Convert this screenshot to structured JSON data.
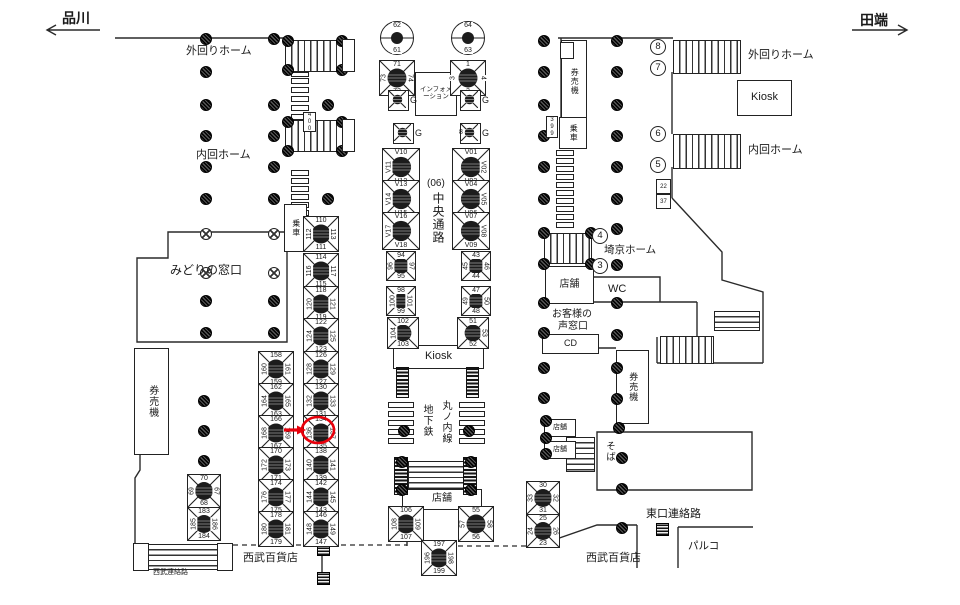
{
  "direction_labels": {
    "left": "品川",
    "right": "田端"
  },
  "labels": [
    {
      "name": "label-shinagawa",
      "t": "品川",
      "x": 62,
      "y": 8,
      "fs": 14,
      "v": false,
      "bold": true
    },
    {
      "name": "label-tabata",
      "t": "田端",
      "x": 860,
      "y": 10,
      "fs": 14,
      "v": false,
      "bold": true
    },
    {
      "name": "label-sotomawari-left",
      "t": "外回りホーム",
      "x": 186,
      "y": 42,
      "fs": 11,
      "v": false
    },
    {
      "name": "label-uchimawari-left",
      "t": "内回ホーム",
      "x": 196,
      "y": 146,
      "fs": 11,
      "v": false
    },
    {
      "name": "label-sotomawari-right",
      "t": "外回りホーム",
      "x": 748,
      "y": 46,
      "fs": 11,
      "v": false
    },
    {
      "name": "label-uchimawari-right",
      "t": "内回ホーム",
      "x": 748,
      "y": 141,
      "fs": 11,
      "v": false
    },
    {
      "name": "label-saikyo-home",
      "t": "埼京ホーム",
      "x": 604,
      "y": 242,
      "fs": 10.5,
      "v": false
    },
    {
      "name": "label-midori-no-madoguchi",
      "t": "みどりの窓口",
      "x": 170,
      "y": 261,
      "fs": 12,
      "v": false
    },
    {
      "name": "label-wc",
      "t": "WC",
      "x": 608,
      "y": 283,
      "fs": 11,
      "v": false
    },
    {
      "name": "label-okyakusama-1",
      "t": "お客様の",
      "x": 552,
      "y": 305,
      "fs": 10,
      "v": false
    },
    {
      "name": "label-okyakusama-2",
      "t": "声窓口",
      "x": 558,
      "y": 317,
      "fs": 10,
      "v": false
    },
    {
      "name": "label-higashiguchi",
      "t": "東口連絡路",
      "x": 646,
      "y": 505,
      "fs": 11,
      "v": false
    },
    {
      "name": "label-parco",
      "t": "パルコ",
      "x": 688,
      "y": 538,
      "fs": 10.5,
      "v": false
    },
    {
      "name": "label-seibu-left",
      "t": "西武百貨店",
      "x": 243,
      "y": 549,
      "fs": 11,
      "v": false
    },
    {
      "name": "label-seibu-right",
      "t": "西武百貨店",
      "x": 586,
      "y": 549,
      "fs": 11,
      "v": false
    },
    {
      "name": "label-seibu-renraku",
      "t": "西武連絡路",
      "x": 153,
      "y": 567,
      "fs": 7,
      "v": false
    },
    {
      "name": "label-chuo-06",
      "t": "(06)",
      "x": 427,
      "y": 178,
      "fs": 10,
      "v": false
    },
    {
      "name": "label-chuo-tsuro",
      "t": "中央通路",
      "x": 430,
      "y": 192,
      "fs": 12,
      "v": true
    },
    {
      "name": "label-marunouchi-sen",
      "t": "丸ノ内線",
      "x": 438,
      "y": 400,
      "fs": 10,
      "v": true
    },
    {
      "name": "label-chikatetsu",
      "t": "地下鉄",
      "x": 419,
      "y": 404,
      "fs": 10,
      "v": true
    },
    {
      "name": "label-soba",
      "t": "そば",
      "x": 602,
      "y": 441,
      "fs": 9.5,
      "v": true
    },
    {
      "name": "label-g-extra-8",
      "t": "8",
      "x": 459,
      "y": 129,
      "fs": 7,
      "v": false
    }
  ],
  "circled_numbers": [
    {
      "t": "8",
      "x": 650,
      "y": 39
    },
    {
      "t": "7",
      "x": 650,
      "y": 60
    },
    {
      "t": "6",
      "x": 650,
      "y": 126
    },
    {
      "t": "5",
      "x": 650,
      "y": 157
    },
    {
      "t": "4",
      "x": 592,
      "y": 228
    },
    {
      "t": "3",
      "x": 592,
      "y": 258
    }
  ],
  "boxed_labels": [
    {
      "name": "kiosk-right",
      "t": "Kiosk",
      "x": 737,
      "y": 80,
      "w": 53,
      "h": 34,
      "fs": 11,
      "v": false
    },
    {
      "name": "information-booth",
      "t": "インフォメーション",
      "x": 415,
      "y": 72,
      "w": 38,
      "h": 40,
      "fs": 6.5,
      "v": false,
      "wrap": true
    },
    {
      "name": "kiosk-center",
      "t": "Kiosk",
      "x": 393,
      "y": 345,
      "w": 89,
      "h": 22,
      "fs": 11,
      "v": false
    },
    {
      "name": "tenpo-saikyo",
      "t": "店舗",
      "x": 545,
      "y": 266,
      "w": 47,
      "h": 36,
      "fs": 10,
      "v": false
    },
    {
      "name": "cd-machine",
      "t": "CD",
      "x": 542,
      "y": 334,
      "w": 55,
      "h": 18,
      "fs": 9,
      "v": false
    },
    {
      "name": "kenbaiki-left",
      "t": "券売機",
      "x": 134,
      "y": 348,
      "w": 33,
      "h": 105,
      "fs": 10,
      "v": true
    },
    {
      "name": "kenbaiki-right-top",
      "t": "券売機",
      "x": 561,
      "y": 40,
      "w": 24,
      "h": 80,
      "fs": 8,
      "v": true
    },
    {
      "name": "josha-right",
      "t": "乗車",
      "x": 559,
      "y": 117,
      "w": 26,
      "h": 30,
      "fs": 8,
      "v": true
    },
    {
      "name": "josha-left",
      "t": "乗車",
      "x": 284,
      "y": 204,
      "w": 21,
      "h": 46,
      "fs": 8,
      "v": true
    },
    {
      "name": "kenbaiki-right-bottom",
      "t": "券売機",
      "x": 616,
      "y": 350,
      "w": 31,
      "h": 72,
      "fs": 9,
      "v": true
    },
    {
      "name": "tenpo-small-1",
      "t": "店舗",
      "x": 544,
      "y": 419,
      "w": 30,
      "h": 16,
      "fs": 7,
      "v": false
    },
    {
      "name": "tenpo-small-2",
      "t": "店舗",
      "x": 544,
      "y": 441,
      "w": 30,
      "h": 16,
      "fs": 7,
      "v": false
    },
    {
      "name": "tenpo-center",
      "t": "店舗",
      "x": 402,
      "y": 489,
      "w": 78,
      "h": 19,
      "fs": 10,
      "v": false
    }
  ],
  "circle_signs": [
    {
      "x": 396,
      "y": 37,
      "top": "62",
      "bottom": "61"
    },
    {
      "x": 467,
      "y": 37,
      "top": "64",
      "bottom": "63"
    }
  ],
  "g_signs": [
    {
      "x": 398,
      "y": 100,
      "label": "G"
    },
    {
      "x": 470,
      "y": 100,
      "label": "G"
    },
    {
      "x": 403,
      "y": 133,
      "label": "G"
    },
    {
      "x": 470,
      "y": 133,
      "label": "G"
    }
  ],
  "ad_boxes": [
    {
      "x": 396,
      "y": 77,
      "s": 34,
      "n": [
        "71",
        "72",
        "73",
        "74"
      ]
    },
    {
      "x": 467,
      "y": 77,
      "s": 34,
      "n": [
        "1",
        "2",
        "3",
        "4"
      ]
    },
    {
      "x": 400,
      "y": 166,
      "s": 36,
      "n": [
        "V10",
        "V12",
        "V11",
        ""
      ]
    },
    {
      "x": 400,
      "y": 198,
      "s": 36,
      "n": [
        "V13",
        "V15",
        "V14",
        ""
      ]
    },
    {
      "x": 400,
      "y": 230,
      "s": 36,
      "n": [
        "V16",
        "V18",
        "V17",
        ""
      ]
    },
    {
      "x": 470,
      "y": 166,
      "s": 36,
      "n": [
        "V01",
        "V03",
        "",
        "V02"
      ]
    },
    {
      "x": 470,
      "y": 198,
      "s": 36,
      "n": [
        "V04",
        "V06",
        "",
        "V05"
      ]
    },
    {
      "x": 470,
      "y": 230,
      "s": 36,
      "n": [
        "V07",
        "V09",
        "",
        "V08"
      ]
    },
    {
      "x": 400,
      "y": 265,
      "s": 28,
      "n": [
        "94",
        "95",
        "96",
        "97"
      ]
    },
    {
      "x": 400,
      "y": 300,
      "s": 28,
      "n": [
        "98",
        "99",
        "100",
        "101"
      ]
    },
    {
      "x": 402,
      "y": 332,
      "s": 30,
      "n": [
        "102",
        "103",
        "104",
        ""
      ]
    },
    {
      "x": 475,
      "y": 265,
      "s": 28,
      "n": [
        "43",
        "44",
        "45",
        "46"
      ]
    },
    {
      "x": 475,
      "y": 300,
      "s": 28,
      "n": [
        "47",
        "48",
        "49",
        "50"
      ]
    },
    {
      "x": 472,
      "y": 332,
      "s": 30,
      "n": [
        "51",
        "52",
        "",
        "53"
      ]
    },
    {
      "x": 320,
      "y": 233,
      "s": 34,
      "n": [
        "110",
        "111",
        "112",
        "113"
      ]
    },
    {
      "x": 320,
      "y": 270,
      "s": 34,
      "n": [
        "114",
        "115",
        "116",
        "117"
      ]
    },
    {
      "x": 320,
      "y": 303,
      "s": 34,
      "n": [
        "118",
        "119",
        "120",
        "121"
      ]
    },
    {
      "x": 320,
      "y": 335,
      "s": 34,
      "n": [
        "122",
        "123",
        "124",
        "125"
      ]
    },
    {
      "x": 320,
      "y": 368,
      "s": 34,
      "n": [
        "126",
        "127",
        "128",
        "129"
      ]
    },
    {
      "x": 320,
      "y": 400,
      "s": 34,
      "n": [
        "130",
        "131",
        "132",
        "133"
      ]
    },
    {
      "x": 320,
      "y": 432,
      "s": 34,
      "n": [
        "134",
        "135",
        "136",
        "137"
      ],
      "highlight": true
    },
    {
      "x": 320,
      "y": 464,
      "s": 34,
      "n": [
        "138",
        "139",
        "140",
        "141"
      ]
    },
    {
      "x": 320,
      "y": 496,
      "s": 34,
      "n": [
        "142",
        "143",
        "144",
        "145"
      ]
    },
    {
      "x": 320,
      "y": 528,
      "s": 34,
      "n": [
        "146",
        "147",
        "148",
        "149"
      ]
    },
    {
      "x": 275,
      "y": 368,
      "s": 34,
      "n": [
        "158",
        "159",
        "160",
        "161"
      ]
    },
    {
      "x": 275,
      "y": 400,
      "s": 34,
      "n": [
        "162",
        "163",
        "164",
        "165"
      ]
    },
    {
      "x": 275,
      "y": 432,
      "s": 34,
      "n": [
        "166",
        "167",
        "168",
        "169"
      ]
    },
    {
      "x": 275,
      "y": 464,
      "s": 34,
      "n": [
        "170",
        "171",
        "172",
        "173"
      ]
    },
    {
      "x": 275,
      "y": 496,
      "s": 34,
      "n": [
        "174",
        "175",
        "176",
        "177"
      ]
    },
    {
      "x": 275,
      "y": 528,
      "s": 34,
      "n": [
        "178",
        "179",
        "180",
        "181"
      ]
    },
    {
      "x": 203,
      "y": 490,
      "s": 32,
      "n": [
        "70",
        "68",
        "69",
        "67"
      ]
    },
    {
      "x": 203,
      "y": 523,
      "s": 32,
      "n": [
        "183",
        "184",
        "185",
        "186"
      ]
    },
    {
      "x": 405,
      "y": 523,
      "s": 34,
      "n": [
        "106",
        "107",
        "108",
        "109"
      ]
    },
    {
      "x": 475,
      "y": 523,
      "s": 34,
      "n": [
        "55",
        "56",
        "57",
        "58"
      ]
    },
    {
      "x": 438,
      "y": 557,
      "s": 34,
      "n": [
        "197",
        "199",
        "196",
        "198"
      ]
    },
    {
      "x": 542,
      "y": 497,
      "s": 32,
      "n": [
        "30",
        "31",
        "33",
        "32"
      ]
    },
    {
      "x": 542,
      "y": 530,
      "s": 32,
      "n": [
        "25",
        "23",
        "24",
        "26"
      ]
    }
  ],
  "tiny_boxes": [
    {
      "x": 303,
      "y": 112,
      "w": 11,
      "h": 18,
      "t": "400",
      "v": true
    },
    {
      "x": 546,
      "y": 116,
      "w": 10,
      "h": 20,
      "t": "399",
      "v": true
    },
    {
      "x": 560,
      "y": 42,
      "w": 12,
      "h": 15,
      "t": "",
      "v": false
    },
    {
      "x": 656,
      "y": 179,
      "w": 13,
      "h": 13,
      "t": "22",
      "v": false
    },
    {
      "x": 656,
      "y": 194,
      "w": 13,
      "h": 13,
      "t": "37",
      "v": false
    },
    {
      "x": 342,
      "y": 39,
      "w": 11,
      "h": 31,
      "t": "",
      "v": true
    },
    {
      "x": 342,
      "y": 119,
      "w": 11,
      "h": 31,
      "t": "",
      "v": true
    },
    {
      "x": 133,
      "y": 543,
      "w": 14,
      "h": 26,
      "t": "",
      "v": false
    },
    {
      "x": 217,
      "y": 543,
      "w": 14,
      "h": 26,
      "t": "",
      "v": false
    }
  ],
  "stairs": [
    {
      "x": 285,
      "y": 40,
      "w": 57,
      "h": 30,
      "dir": "v"
    },
    {
      "x": 285,
      "y": 120,
      "w": 57,
      "h": 30,
      "dir": "v"
    },
    {
      "x": 673,
      "y": 40,
      "w": 66,
      "h": 32,
      "dir": "v"
    },
    {
      "x": 673,
      "y": 134,
      "w": 66,
      "h": 33,
      "dir": "v"
    },
    {
      "x": 544,
      "y": 233,
      "w": 46,
      "h": 29,
      "dir": "v"
    },
    {
      "x": 714,
      "y": 311,
      "w": 44,
      "h": 18,
      "dir": "h"
    },
    {
      "x": 660,
      "y": 336,
      "w": 52,
      "h": 26,
      "dir": "v"
    },
    {
      "x": 408,
      "y": 461,
      "w": 56,
      "h": 26,
      "dir": "h"
    },
    {
      "x": 566,
      "y": 437,
      "w": 27,
      "h": 33,
      "dir": "h"
    },
    {
      "x": 147,
      "y": 544,
      "w": 70,
      "h": 24,
      "dir": "h"
    }
  ],
  "towers": [
    {
      "x": 396,
      "y": 367,
      "w": 11,
      "h": 29
    },
    {
      "x": 466,
      "y": 367,
      "w": 11,
      "h": 29
    },
    {
      "x": 394,
      "y": 457,
      "w": 12,
      "h": 36
    },
    {
      "x": 463,
      "y": 457,
      "w": 12,
      "h": 36
    }
  ],
  "ladders": [
    {
      "x": 291,
      "y": 72,
      "w": 16,
      "h": 3,
      "count": 1,
      "step": 9
    },
    {
      "x": 291,
      "y": 78,
      "w": 16,
      "h": 4,
      "count": 5,
      "step": 9
    },
    {
      "x": 291,
      "y": 170,
      "w": 16,
      "h": 4,
      "count": 6,
      "step": 8
    },
    {
      "x": 556,
      "y": 150,
      "w": 16,
      "h": 4,
      "count": 10,
      "step": 8
    },
    {
      "x": 388,
      "y": 402,
      "w": 24,
      "h": 4,
      "count": 5,
      "step": 9
    },
    {
      "x": 459,
      "y": 402,
      "w": 24,
      "h": 4,
      "count": 5,
      "step": 9
    }
  ],
  "pillars": [
    [
      205,
      38
    ],
    [
      273,
      38
    ],
    [
      543,
      40
    ],
    [
      616,
      40
    ],
    [
      205,
      71
    ],
    [
      543,
      71
    ],
    [
      616,
      71
    ],
    [
      205,
      104
    ],
    [
      273,
      104
    ],
    [
      327,
      104
    ],
    [
      543,
      104
    ],
    [
      616,
      104
    ],
    [
      205,
      135
    ],
    [
      273,
      135
    ],
    [
      543,
      135
    ],
    [
      616,
      135
    ],
    [
      205,
      166
    ],
    [
      273,
      166
    ],
    [
      543,
      166
    ],
    [
      616,
      166
    ],
    [
      205,
      198
    ],
    [
      273,
      198
    ],
    [
      327,
      198
    ],
    [
      543,
      198
    ],
    [
      616,
      198
    ],
    [
      287,
      40
    ],
    [
      341,
      40
    ],
    [
      287,
      69
    ],
    [
      341,
      69
    ],
    [
      287,
      121
    ],
    [
      341,
      121
    ],
    [
      287,
      150
    ],
    [
      341,
      150
    ],
    [
      543,
      232
    ],
    [
      590,
      232
    ],
    [
      543,
      263
    ],
    [
      590,
      263
    ],
    [
      616,
      228
    ],
    [
      616,
      264
    ],
    [
      205,
      300
    ],
    [
      273,
      300
    ],
    [
      543,
      302
    ],
    [
      616,
      302
    ],
    [
      205,
      332
    ],
    [
      273,
      332
    ],
    [
      543,
      332
    ],
    [
      616,
      334
    ],
    [
      543,
      367
    ],
    [
      616,
      367
    ],
    [
      543,
      397
    ],
    [
      616,
      398
    ],
    [
      203,
      400
    ],
    [
      203,
      430
    ],
    [
      203,
      460
    ],
    [
      618,
      427
    ],
    [
      621,
      457
    ],
    [
      621,
      488
    ],
    [
      621,
      527
    ],
    [
      545,
      420
    ],
    [
      545,
      437
    ],
    [
      545,
      453
    ],
    [
      401,
      461
    ],
    [
      401,
      489
    ],
    [
      470,
      461
    ],
    [
      470,
      489
    ],
    [
      403,
      430
    ],
    [
      468,
      430
    ]
  ],
  "x_pillars": [
    [
      205,
      233
    ],
    [
      273,
      233
    ],
    [
      205,
      272
    ],
    [
      273,
      272
    ]
  ],
  "hatch_squares": [
    [
      317,
      543
    ],
    [
      317,
      572
    ],
    [
      656,
      523
    ]
  ],
  "highlight": {
    "color": "#e8000b",
    "ellipse": {
      "cx": 318,
      "cy": 430,
      "rx": 16,
      "ry": 13
    },
    "arrow": {
      "x1": 284,
      "y1": 430,
      "x2": 297,
      "y2": 430
    }
  },
  "colors": {
    "line": "#2a2a2a",
    "background": "#ffffff"
  }
}
